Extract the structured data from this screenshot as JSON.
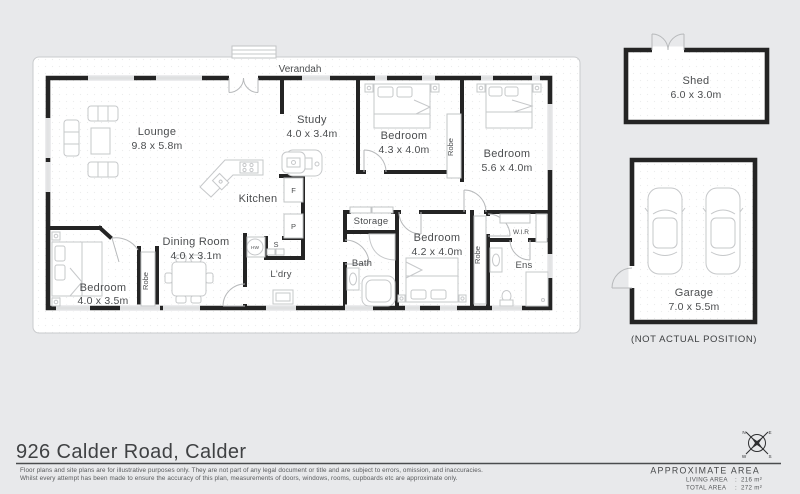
{
  "colors": {
    "background": "#e8e9eb",
    "wall": "#242424",
    "furniture": "#c6c8ca"
  },
  "plan": {
    "verandah_label": "Verandah",
    "rooms": [
      {
        "name": "Lounge",
        "dims": "9.8 x 5.8m"
      },
      {
        "name": "Study",
        "dims": "4.0 x 3.4m"
      },
      {
        "name": "Bedroom",
        "dims": "4.3 x 4.0m"
      },
      {
        "name": "Bedroom",
        "dims": "5.6 x 4.0m"
      },
      {
        "name": "Kitchen"
      },
      {
        "name": "Dining Room",
        "dims": "4.0 x 3.1m"
      },
      {
        "name": "Bedroom",
        "dims": "4.0 x 3.5m"
      },
      {
        "name": "Bedroom",
        "dims": "4.2 x 4.0m"
      },
      {
        "name": "Storage"
      },
      {
        "name": "Bath"
      },
      {
        "name": "L'dry"
      },
      {
        "name": "Ens"
      },
      {
        "name": "W.I.R"
      }
    ],
    "fixtures": {
      "robe": "Robe",
      "fridge": "F",
      "pantry": "P",
      "sink": "S",
      "hot_water": "HW"
    }
  },
  "outbuildings": {
    "shed": {
      "name": "Shed",
      "dims": "6.0 x 3.0m"
    },
    "garage": {
      "name": "Garage",
      "dims": "7.0 x 5.5m",
      "note": "(NOT ACTUAL POSITION)"
    }
  },
  "compass": {
    "n": "N",
    "e": "E",
    "s": "S",
    "w": "W"
  },
  "footer": {
    "title": "926 Calder Road, Calder",
    "disclaimer_line1": "Floor plans and site plans are for illustrative purposes only. They are not part of any legal document or title and are subject to errors, omission, and inaccuracies.",
    "disclaimer_line2": "Whilst every attempt has been made to ensure the accuracy of this plan, measurements of doors, windows, rooms, cupboards etc are approximate only.",
    "area": {
      "heading": "APPROXIMATE AREA",
      "living_label": "LIVING AREA",
      "living_value": "216 m²",
      "total_label": "TOTAL AREA",
      "total_value": "272 m²",
      "separator": ":"
    }
  }
}
